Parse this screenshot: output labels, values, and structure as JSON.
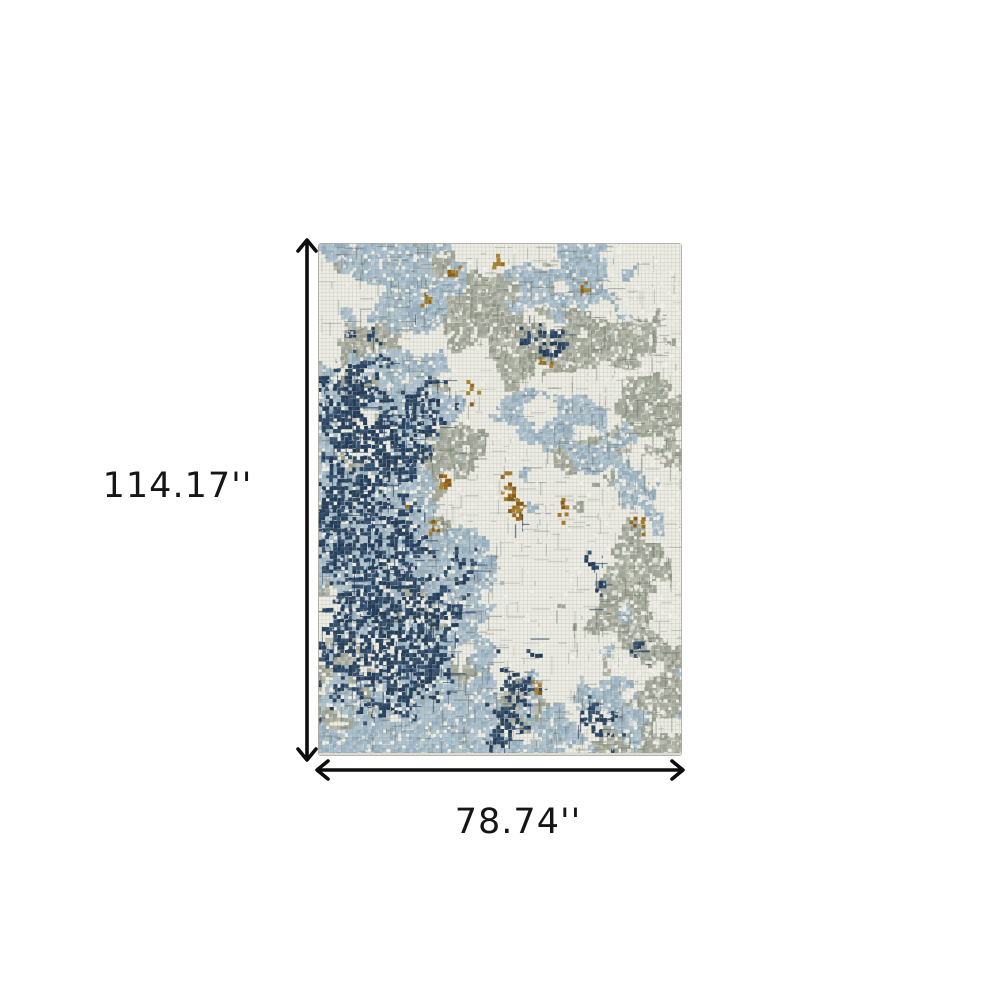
{
  "page": {
    "background": "#ffffff"
  },
  "diagram": {
    "type": "product-dimension-diagram",
    "product": "abstract distressed area rug",
    "height_dimension": {
      "label": "114.17''"
    },
    "width_dimension": {
      "label": "78.74''"
    },
    "arrow_color": "#0d0d0d",
    "label_color": "#161616",
    "rug": {
      "palette": {
        "cream": "#eeede5",
        "light_blue": "#a9bfce",
        "sage_gray": "#a7ab9d",
        "gray": "#b5b8ac",
        "navy": "#2e4a68",
        "ochre": "#9e6d1d",
        "edge": "#dcdcd2"
      }
    }
  }
}
